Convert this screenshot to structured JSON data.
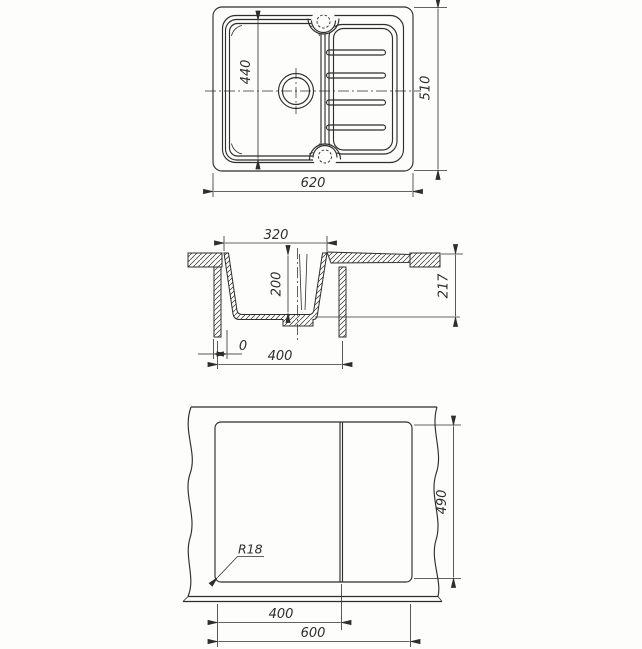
{
  "drawing": {
    "description": "Technical drawing of a kitchen sink with drainboard: top view, cross-section and worktop cut-out template",
    "colors": {
      "line": "#2e2e2e",
      "background": "#fdfdfb"
    },
    "top_view": {
      "bowl_inner_length": "440",
      "overall_depth": "510",
      "overall_width": "620"
    },
    "section_view": {
      "bowl_top_width": "320",
      "bowl_depth": "200",
      "total_height": "217",
      "front_offset": "0",
      "cabinet_width": "400"
    },
    "cutout_view": {
      "cutout_height": "490",
      "left_section_width": "400",
      "cutout_width": "600",
      "corner_radius_label": "R18"
    }
  }
}
